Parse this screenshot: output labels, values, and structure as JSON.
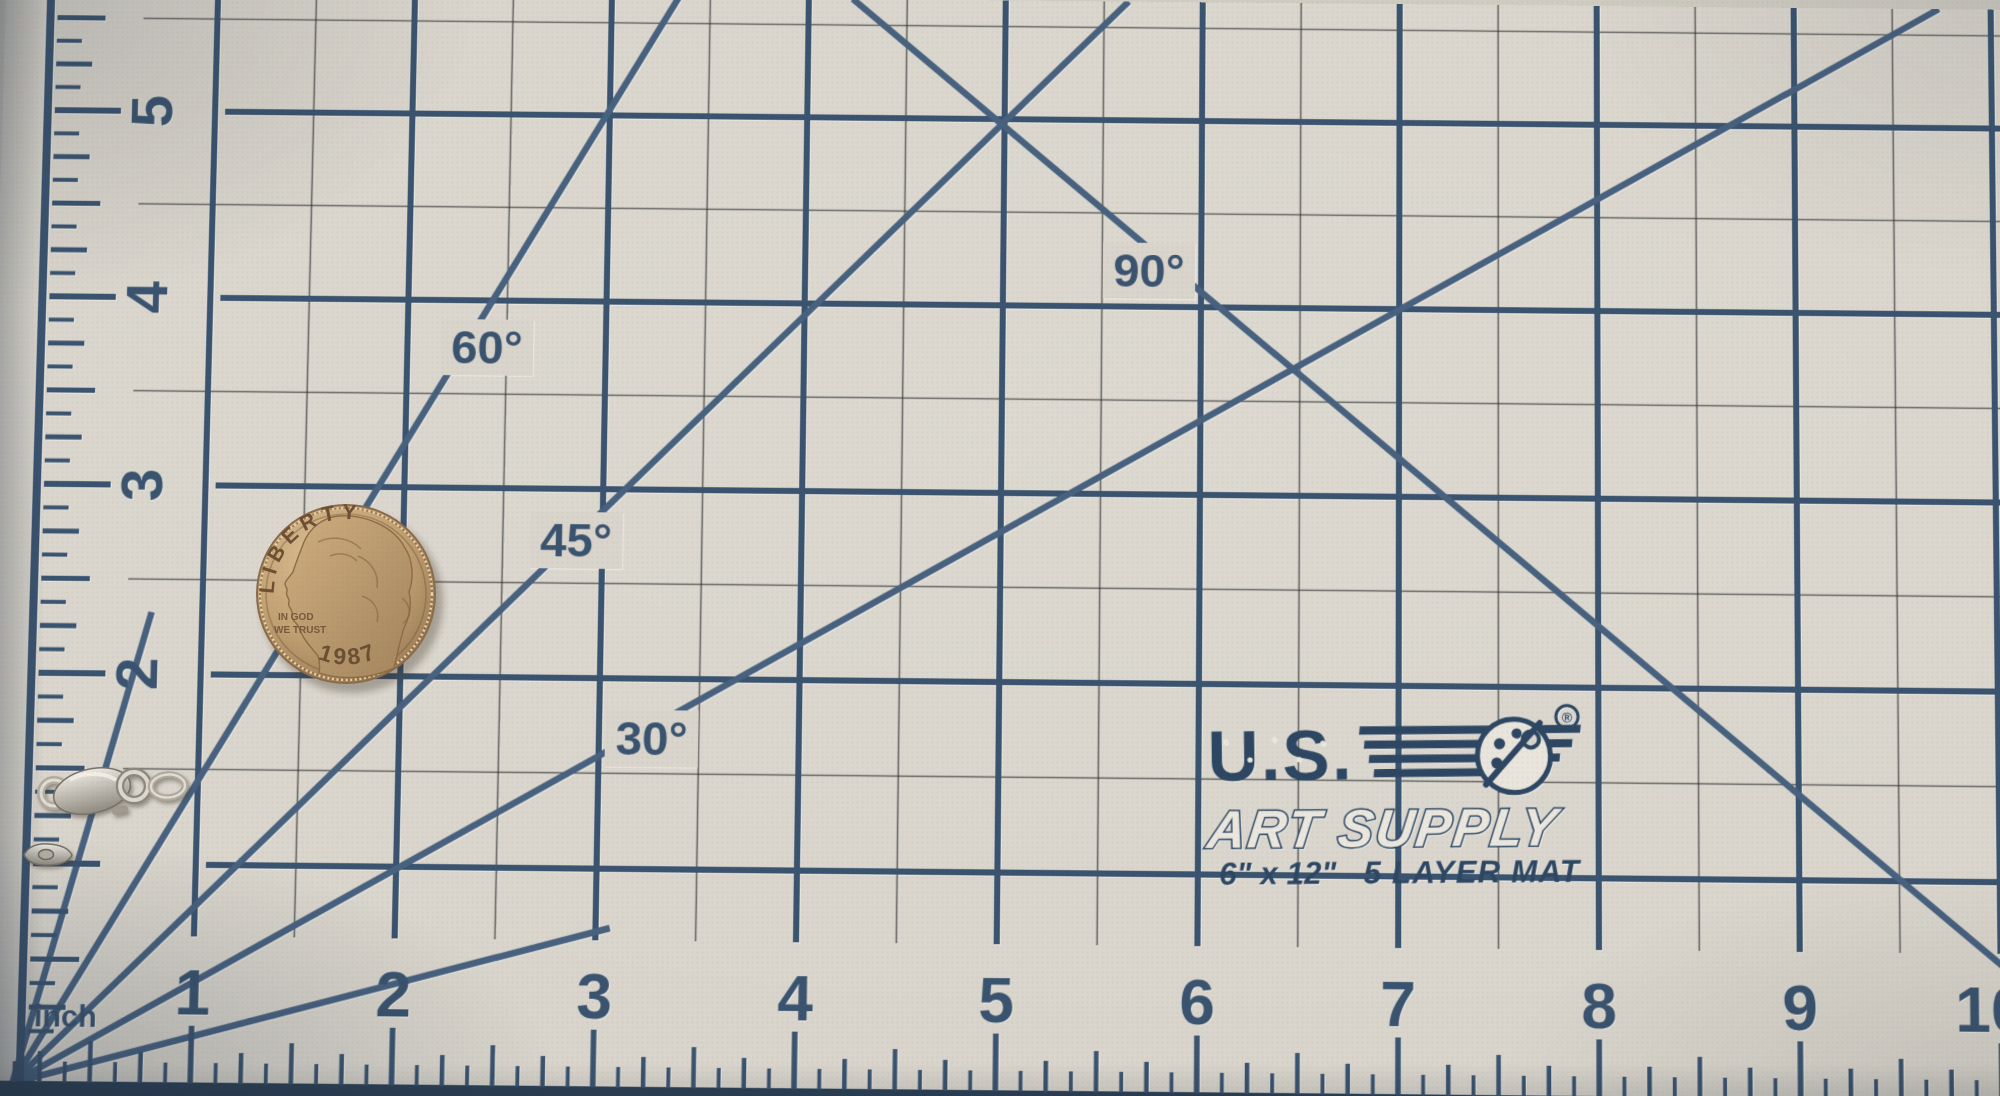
{
  "scene": {
    "description": "Silver rope chain necklace with lobster clasp and a 1987 US quarter lying on a blue-gridded cutting mat"
  },
  "colors": {
    "mat": "#d9d5cc",
    "grid_major": "#3a536f",
    "grid_minor": "#2f2f2f",
    "diagonal": "#47617f",
    "mat_edge_strip": "#2c4156",
    "logo_navy": "#2d4763",
    "coin_gold": "#c2a173",
    "coin_text": "#6d4f33",
    "chain_silver": "#d7cdb9"
  },
  "left_ruler": {
    "numbers": [
      "5",
      "4",
      "3",
      "2"
    ]
  },
  "bottom_ruler": {
    "numbers": [
      "1",
      "2",
      "3",
      "4",
      "5",
      "6",
      "7",
      "8",
      "9",
      "10"
    ],
    "unit_label": "inch"
  },
  "angle_labels": [
    {
      "text": "30°"
    },
    {
      "text": "45°"
    },
    {
      "text": "60°"
    },
    {
      "text": "90°"
    }
  ],
  "logo": {
    "brand_top": "U.S.",
    "brand_bottom": "ART SUPPLY",
    "registered_mark": "®",
    "size_text": "6\" x 12\"",
    "product_text": "5 LAYER MAT"
  },
  "coin": {
    "legend_top": "LIBERTY",
    "motto_line1": "IN GOD",
    "motto_line2": "WE TRUST",
    "date": "1987"
  }
}
